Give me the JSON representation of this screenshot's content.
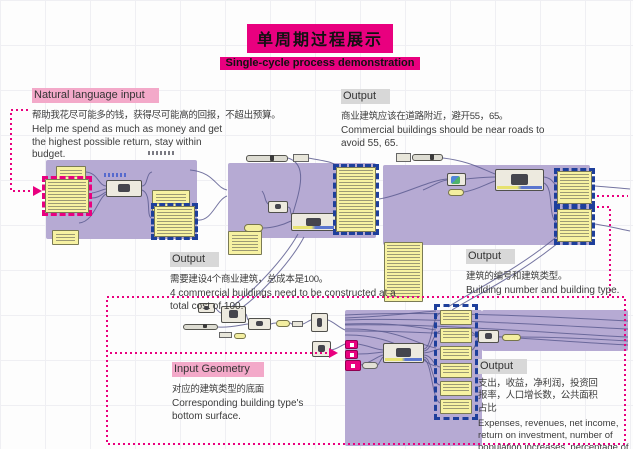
{
  "title": {
    "cn": "单周期过程展示",
    "en": "Single-cycle process demonstration"
  },
  "annotations": {
    "natural_language_input": {
      "label": "Natural language input",
      "cn": "帮助我花尽可能多的钱，获得尽可能高的回报，不超出预算。",
      "en": "Help me spend as much as money and get the highest possible return, stay within budget."
    },
    "output_top_right": {
      "label": "Output",
      "cn": "商业建筑应该在道路附近，避开55，65。",
      "en": "Commercial buildings should be near roads to avoid 55, 65."
    },
    "output_mid_left": {
      "label": "Output",
      "cn": "需要建设4个商业建筑，总成本是100。",
      "en": "4 commercial buildings need to be constructed at a total cost of 100."
    },
    "output_mid_right": {
      "label": "Output",
      "cn": "建筑的编号和建筑类型。",
      "en": "Building number and building type."
    },
    "input_geometry": {
      "label": "Input Geometry",
      "cn": "对应的建筑类型的底面",
      "en": "Corresponding building type's bottom surface."
    },
    "output_bottom_right": {
      "label": "Output",
      "cn": "支出，收益，净利润，投资回报率，人口增长数，公共面积占比",
      "en": "Expenses, revenues, net income, return on investment, number of population increases, percentage of public square footage"
    }
  },
  "colors": {
    "accent_magenta": "#e9007f",
    "pink_highlight": "#f3a9c9",
    "gray_highlight": "#d8d8d8",
    "group_purple": "#b6aad3",
    "panel_yellow": "#f7f2a2",
    "selection_blue": "#1e3f9b",
    "wire": "#5d5d91"
  }
}
